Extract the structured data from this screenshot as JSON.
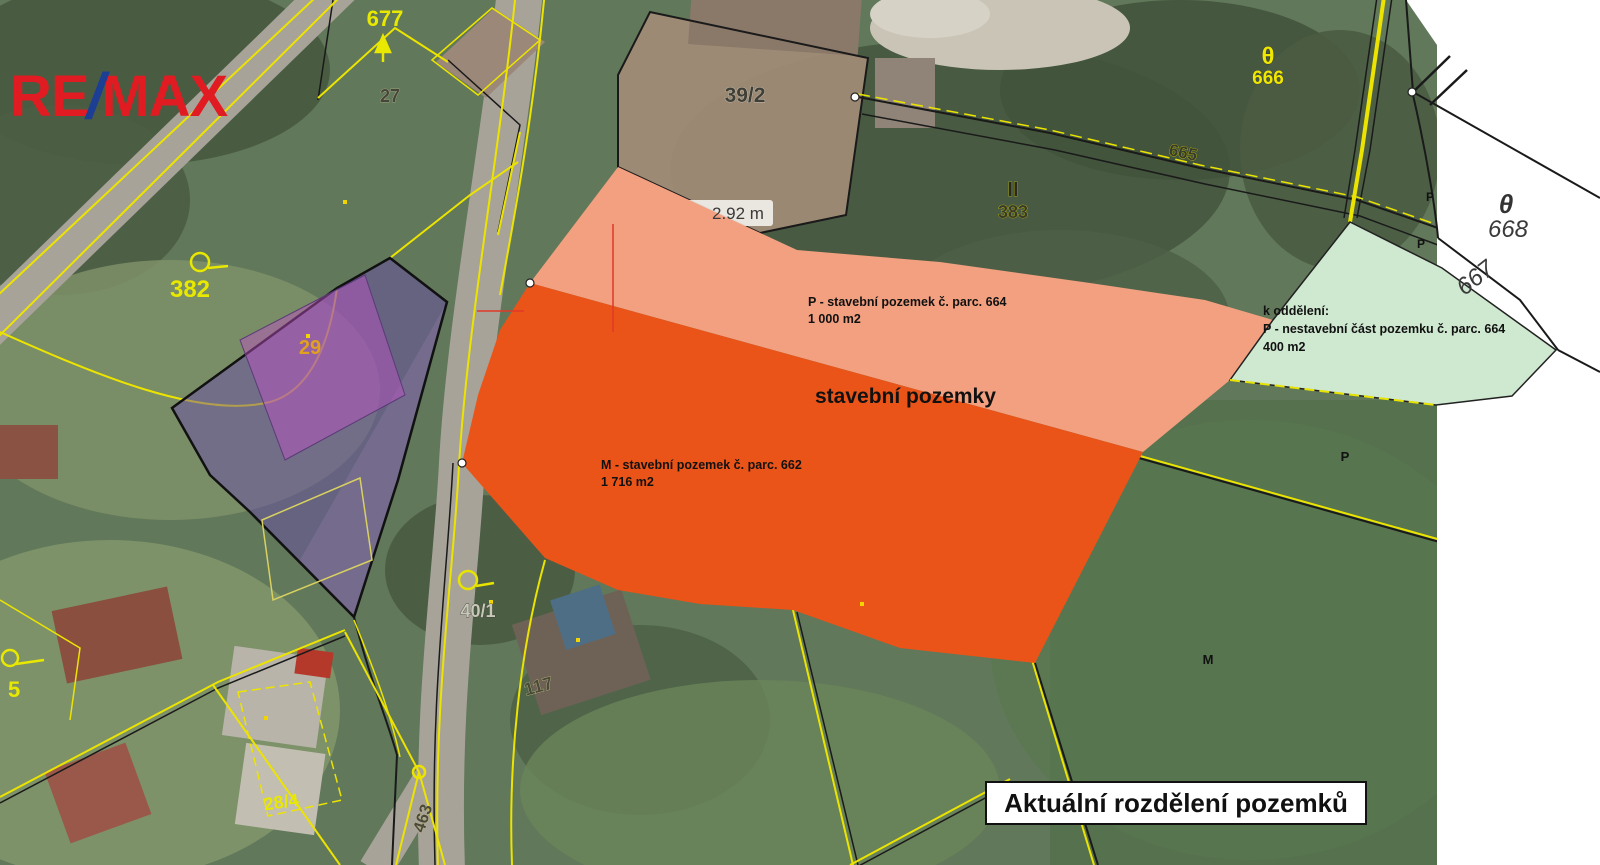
{
  "logo": {
    "re": "RE",
    "slash": "/",
    "max": "MAX"
  },
  "title": "Aktuální rozdělení pozemků",
  "overlays": {
    "heading": "stavební pozemky",
    "parcel_m": {
      "name_line": "M - stavební pozemek č. parc. 662",
      "area_line": "1 716 m2",
      "color": "#ea5418"
    },
    "parcel_p": {
      "name_line": "P - stavební pozemek č. parc. 664",
      "area_line": "1 000 m2",
      "color": "#f2a080"
    },
    "parcel_green": {
      "line1": "k oddělení:",
      "line2": "P - nestavební část pozemku č. parc. 664",
      "line3": "400 m2",
      "color": "#cfe8d0"
    },
    "parcel_purple": {
      "color": "#6a4ab0"
    }
  },
  "measurement_label": "2.92 m",
  "labels": {
    "n677": "677",
    "n27": "27",
    "n382": "382",
    "n29": "29",
    "n39_2": "39/2",
    "n383": "383",
    "sym_ii": "II",
    "n666": "666",
    "n665": "665",
    "n668": "668",
    "n667": "667",
    "n5": "5",
    "n28_4": "28/4",
    "n117": "117",
    "n40_1": "40/1",
    "n463": "463",
    "p": "P",
    "m": "M",
    "theta": "θ"
  },
  "colors": {
    "remax_red": "#e11b22",
    "remax_blue": "#1c3f94",
    "cadastre_yellow": "#ece400",
    "orange": "#ea5418",
    "salmon": "#f2a080",
    "green": "#cfe8d0",
    "purple": "#6a4ab0",
    "white_panel": "#ffffff"
  }
}
